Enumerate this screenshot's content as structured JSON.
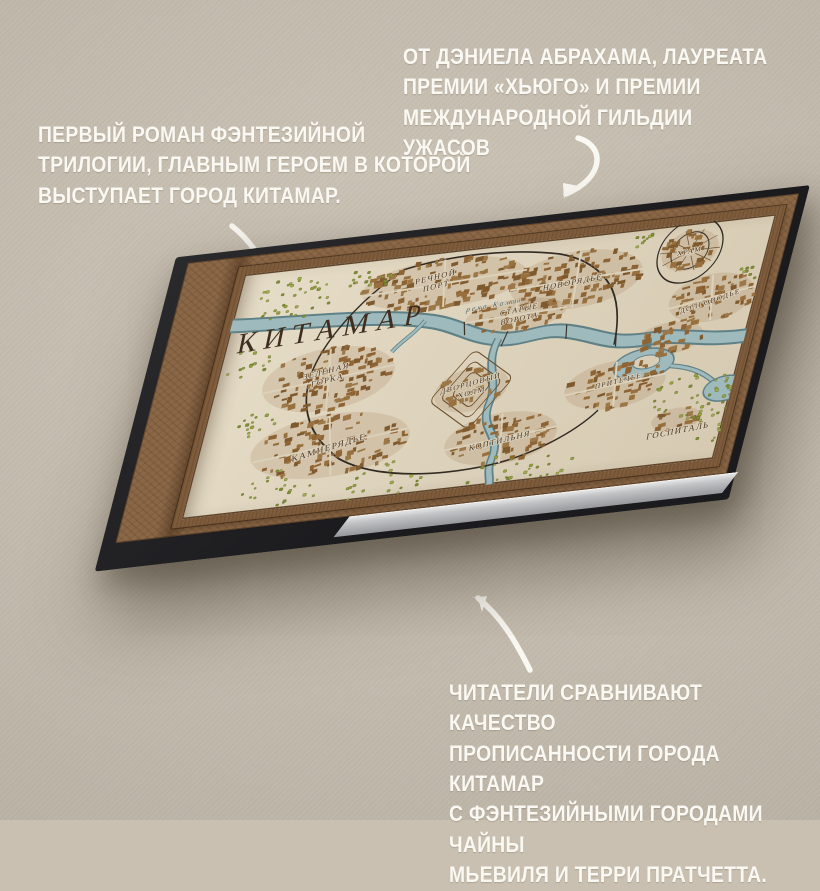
{
  "background": {
    "color": "#c9c0b1",
    "text_color": "#faf8f2"
  },
  "annotations": {
    "left": {
      "text": "ПЕРВЫЙ РОМАН ФЭНТЕЗИЙНОЙ\nТРИЛОГИИ, ГЛАВНЫМ ГЕРОЕМ В КОТОРОЙ\nВЫСТУПАЕТ ГОРОД КИТАМАР."
    },
    "top_right": {
      "text": "ОТ ДЭНИЕЛА АБРАХАМА, ЛАУРЕАТА\nПРЕМИИ «ХЬЮГО» И ПРЕМИИ\nМЕЖДУНАРОДНОЙ ГИЛЬДИИ УЖАСОВ"
    },
    "bottom_right": {
      "text": "ЧИТАТЕЛИ СРАВНИВАЮТ КАЧЕСТВО\nПРОПИСАННОСТИ ГОРОДА КИТАМАР\nС ФЭНТЕЗИЙНЫМИ ГОРОДАМИ ЧАЙНЫ\nМЬЕВИЛЯ И ТЕРРИ ПРАТЧЕТТА."
    }
  },
  "map": {
    "title": "КИТАМАР",
    "river_label": "река Кахон",
    "labels": {
      "riverport": [
        "РЕЧНОЙ",
        "ПОРТ"
      ],
      "newmarket": [
        "НОВОРЯДЬЕ"
      ],
      "temple": [
        "ХРАМ"
      ],
      "longwater": [
        "ДОЛГОВОДЬЕ"
      ],
      "oldgate": [
        "СТАРЫЕ",
        "ВОРОТА"
      ],
      "greenhill": [
        "ЗЕЛЁНАЯ",
        "ГОРКА"
      ],
      "palacehill": [
        "ДВОРЦОВЫЙ",
        "ХОЛМ"
      ],
      "stonemarket": [
        "КАМНЕРЯДЬЕ"
      ],
      "smoke": [
        "КОПТИЛЬНЯ"
      ],
      "seepwater": [
        "ПРИТЕЧЬЕ"
      ],
      "hospital": [
        "ГОСПИТАЛЬ"
      ]
    },
    "colors": {
      "paper": "#ddd2bb",
      "blocks": "#8e6434",
      "river": "#9fbabd",
      "river_edge": "#5e8187",
      "trees": "#95a040",
      "wall": "#322b22",
      "label_ink": "#4a3626"
    }
  }
}
